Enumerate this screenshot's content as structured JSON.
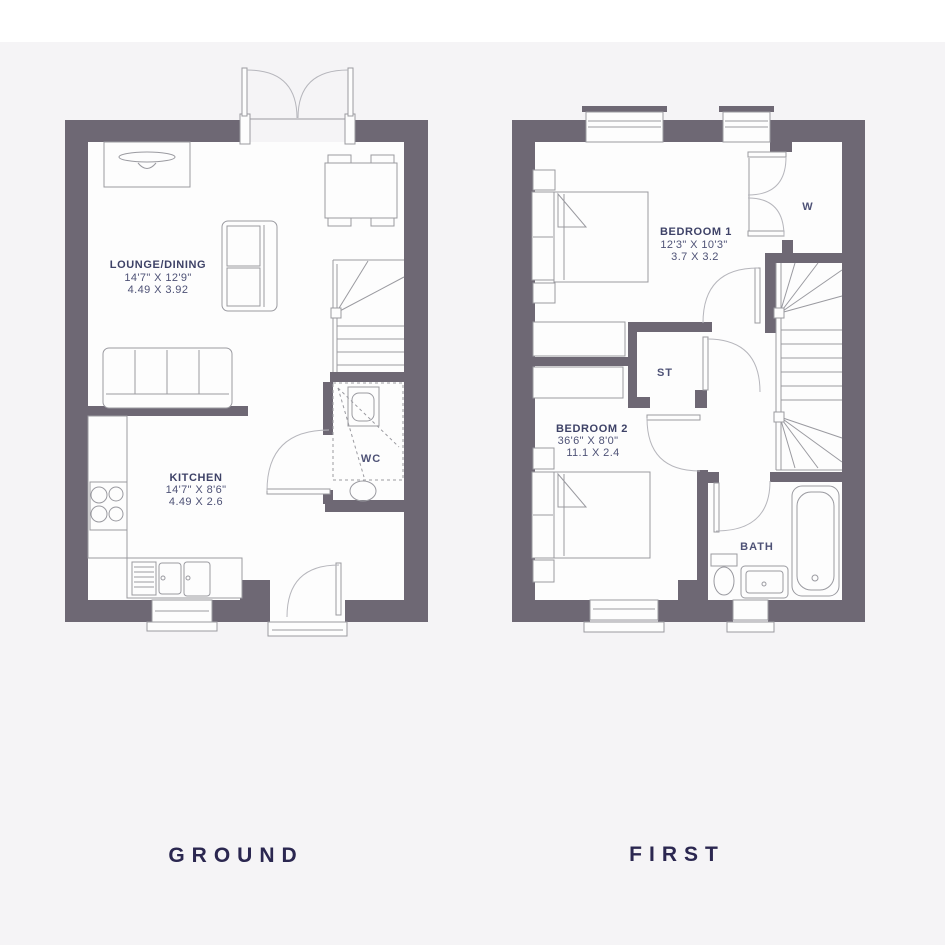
{
  "colors": {
    "bg": "#f5f4f6",
    "band": "#ffffff",
    "wall": "#6e6874",
    "interior": "#fdfdfd",
    "line": "#9a9aa0",
    "arc": "#b6b6bc",
    "label": "#3e4267",
    "dim": "#4e5276",
    "caption": "#2b2750"
  },
  "ground_floor": {
    "caption": "GROUND",
    "rooms": [
      {
        "id": "lounge",
        "name": "LOUNGE/DINING",
        "imperial": "14'7\" X 12'9\"",
        "metric": "4.49 X 3.92"
      },
      {
        "id": "kitchen",
        "name": "KITCHEN",
        "imperial": "14'7\" X 8'6\"",
        "metric": "4.49 X 2.6"
      },
      {
        "id": "wc",
        "name": "WC"
      }
    ]
  },
  "first_floor": {
    "caption": "FIRST",
    "rooms": [
      {
        "id": "bedroom1",
        "name": "BEDROOM 1",
        "imperial": "12'3\" X 10'3\"",
        "metric": "3.7 X 3.2"
      },
      {
        "id": "bedroom2",
        "name": "BEDROOM 2",
        "imperial": "36'6\" X 8'0\"",
        "metric": "11.1 X 2.4"
      },
      {
        "id": "store",
        "name": "ST"
      },
      {
        "id": "wardrobe",
        "name": "W"
      },
      {
        "id": "bath",
        "name": "BATH"
      }
    ]
  }
}
